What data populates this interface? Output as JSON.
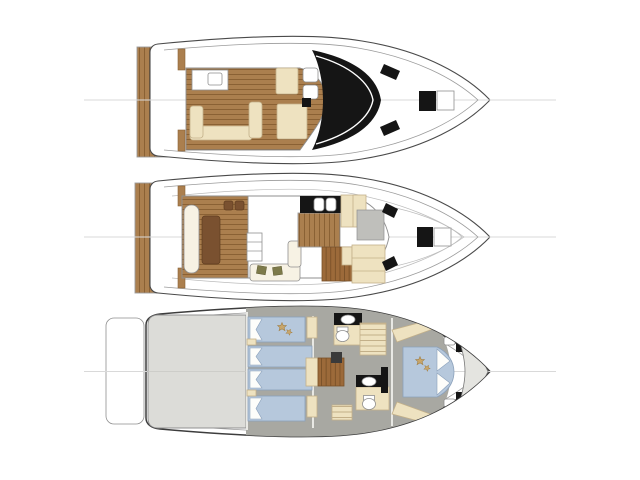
{
  "page": {
    "background": "#ffffff"
  },
  "colors": {
    "hull": "#4a4a4a",
    "hull-light": "#9b9b9b",
    "fline": "#8f8f8f",
    "cline": "#d9d9d9",
    "wall": "#f0f0ec",
    "teak": "#ab7f4e",
    "teak-line": "#8a6134",
    "teak-dark": "#7a5130",
    "cream": "#eee2c0",
    "cream-line": "#c3b089",
    "cwhite": "#f7f2e4",
    "black": "#151515",
    "blue": "#b6c8dc",
    "blue-line": "#8ba1bb",
    "gfloor": "#a8a8a2",
    "gengine": "#dcdcd8",
    "gpanel": "#bfbfbb",
    "gbow": "#e4e4e0",
    "wood": "#9c6a3a",
    "wood-line": "#7a5128",
    "olive": "#7d7a4a",
    "star": "#c8a66b"
  },
  "diagram": {
    "type": "yacht-deck-plans",
    "decks": [
      {
        "id": "flybridge-deck",
        "features": [
          "swim-platform",
          "sun-pad",
          "u-shaped-settee",
          "bench-seats",
          "helm-seats",
          "windshield-arch",
          "side-windows",
          "foredeck-hatch",
          "anchor-locker"
        ]
      },
      {
        "id": "main-deck",
        "features": [
          "swim-platform",
          "cockpit-bench",
          "cockpit-table",
          "cockpit-chairs",
          "salon-cabinet",
          "salon-sofa",
          "galley-counter",
          "galley-cabinets",
          "helm-console",
          "dinette",
          "side-hatches",
          "foredeck-hatch",
          "anchor-locker"
        ]
      },
      {
        "id": "lower-deck",
        "features": [
          "swim-platform",
          "engine-room",
          "guest-berths",
          "double-berths",
          "staircase",
          "forward-head",
          "aft-head",
          "companionway-steps",
          "wardrobes",
          "master-v-berth",
          "bow-locker"
        ]
      }
    ]
  }
}
